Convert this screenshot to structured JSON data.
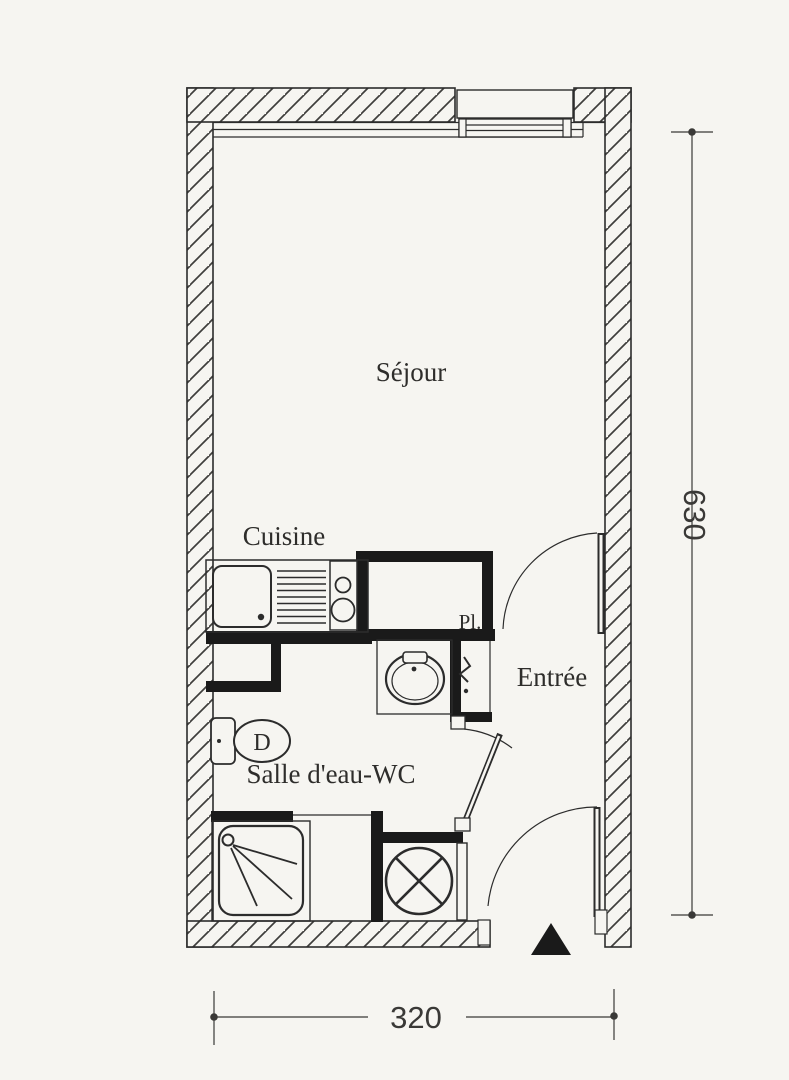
{
  "plan": {
    "type": "studio-apartment-floor-plan",
    "labels": {
      "sejour": "Séjour",
      "cuisine": "Cuisine",
      "entree": "Entrée",
      "salle_eau_wc": "Salle d'eau-WC",
      "placard_abbrev": "Pl.",
      "toilet_mark": "D"
    },
    "dimensions": {
      "width": "320",
      "height": "630"
    },
    "colors": {
      "paper": "#f6f5f1",
      "ink": "#2c2c2c",
      "partition_fill": "#1a1a1a"
    },
    "fixtures": [
      "window",
      "kitchen-sink",
      "drainboard",
      "cooktop",
      "placard-closet",
      "water-heater-zigzag",
      "washbasin",
      "toilet",
      "shower",
      "washing-machine",
      "sejour-door",
      "bathroom-door",
      "entrance-door",
      "entrance-marker-triangle"
    ]
  }
}
